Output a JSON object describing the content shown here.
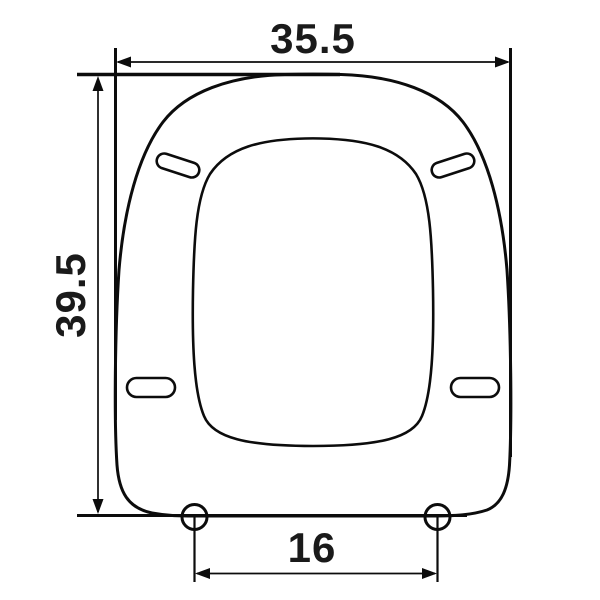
{
  "diagram": {
    "name": "toilet-seat-dimension-drawing",
    "view": "top view technical line drawing of a square toilet seat",
    "units_shown": false
  },
  "dimensions": {
    "overall_width": {
      "label": "35.5",
      "orientation": "horizontal-top"
    },
    "overall_depth": {
      "label": "39.5",
      "orientation": "vertical-left-rotated"
    },
    "hinge_hole_spacing": {
      "label": "16",
      "orientation": "horizontal-bottom"
    }
  },
  "features": {
    "bumper_slots_count": 4,
    "hinge_holes_count": 2
  },
  "colors": {
    "line": "#0c0c0c",
    "text": "#1a1a1a",
    "background": "#ffffff"
  }
}
